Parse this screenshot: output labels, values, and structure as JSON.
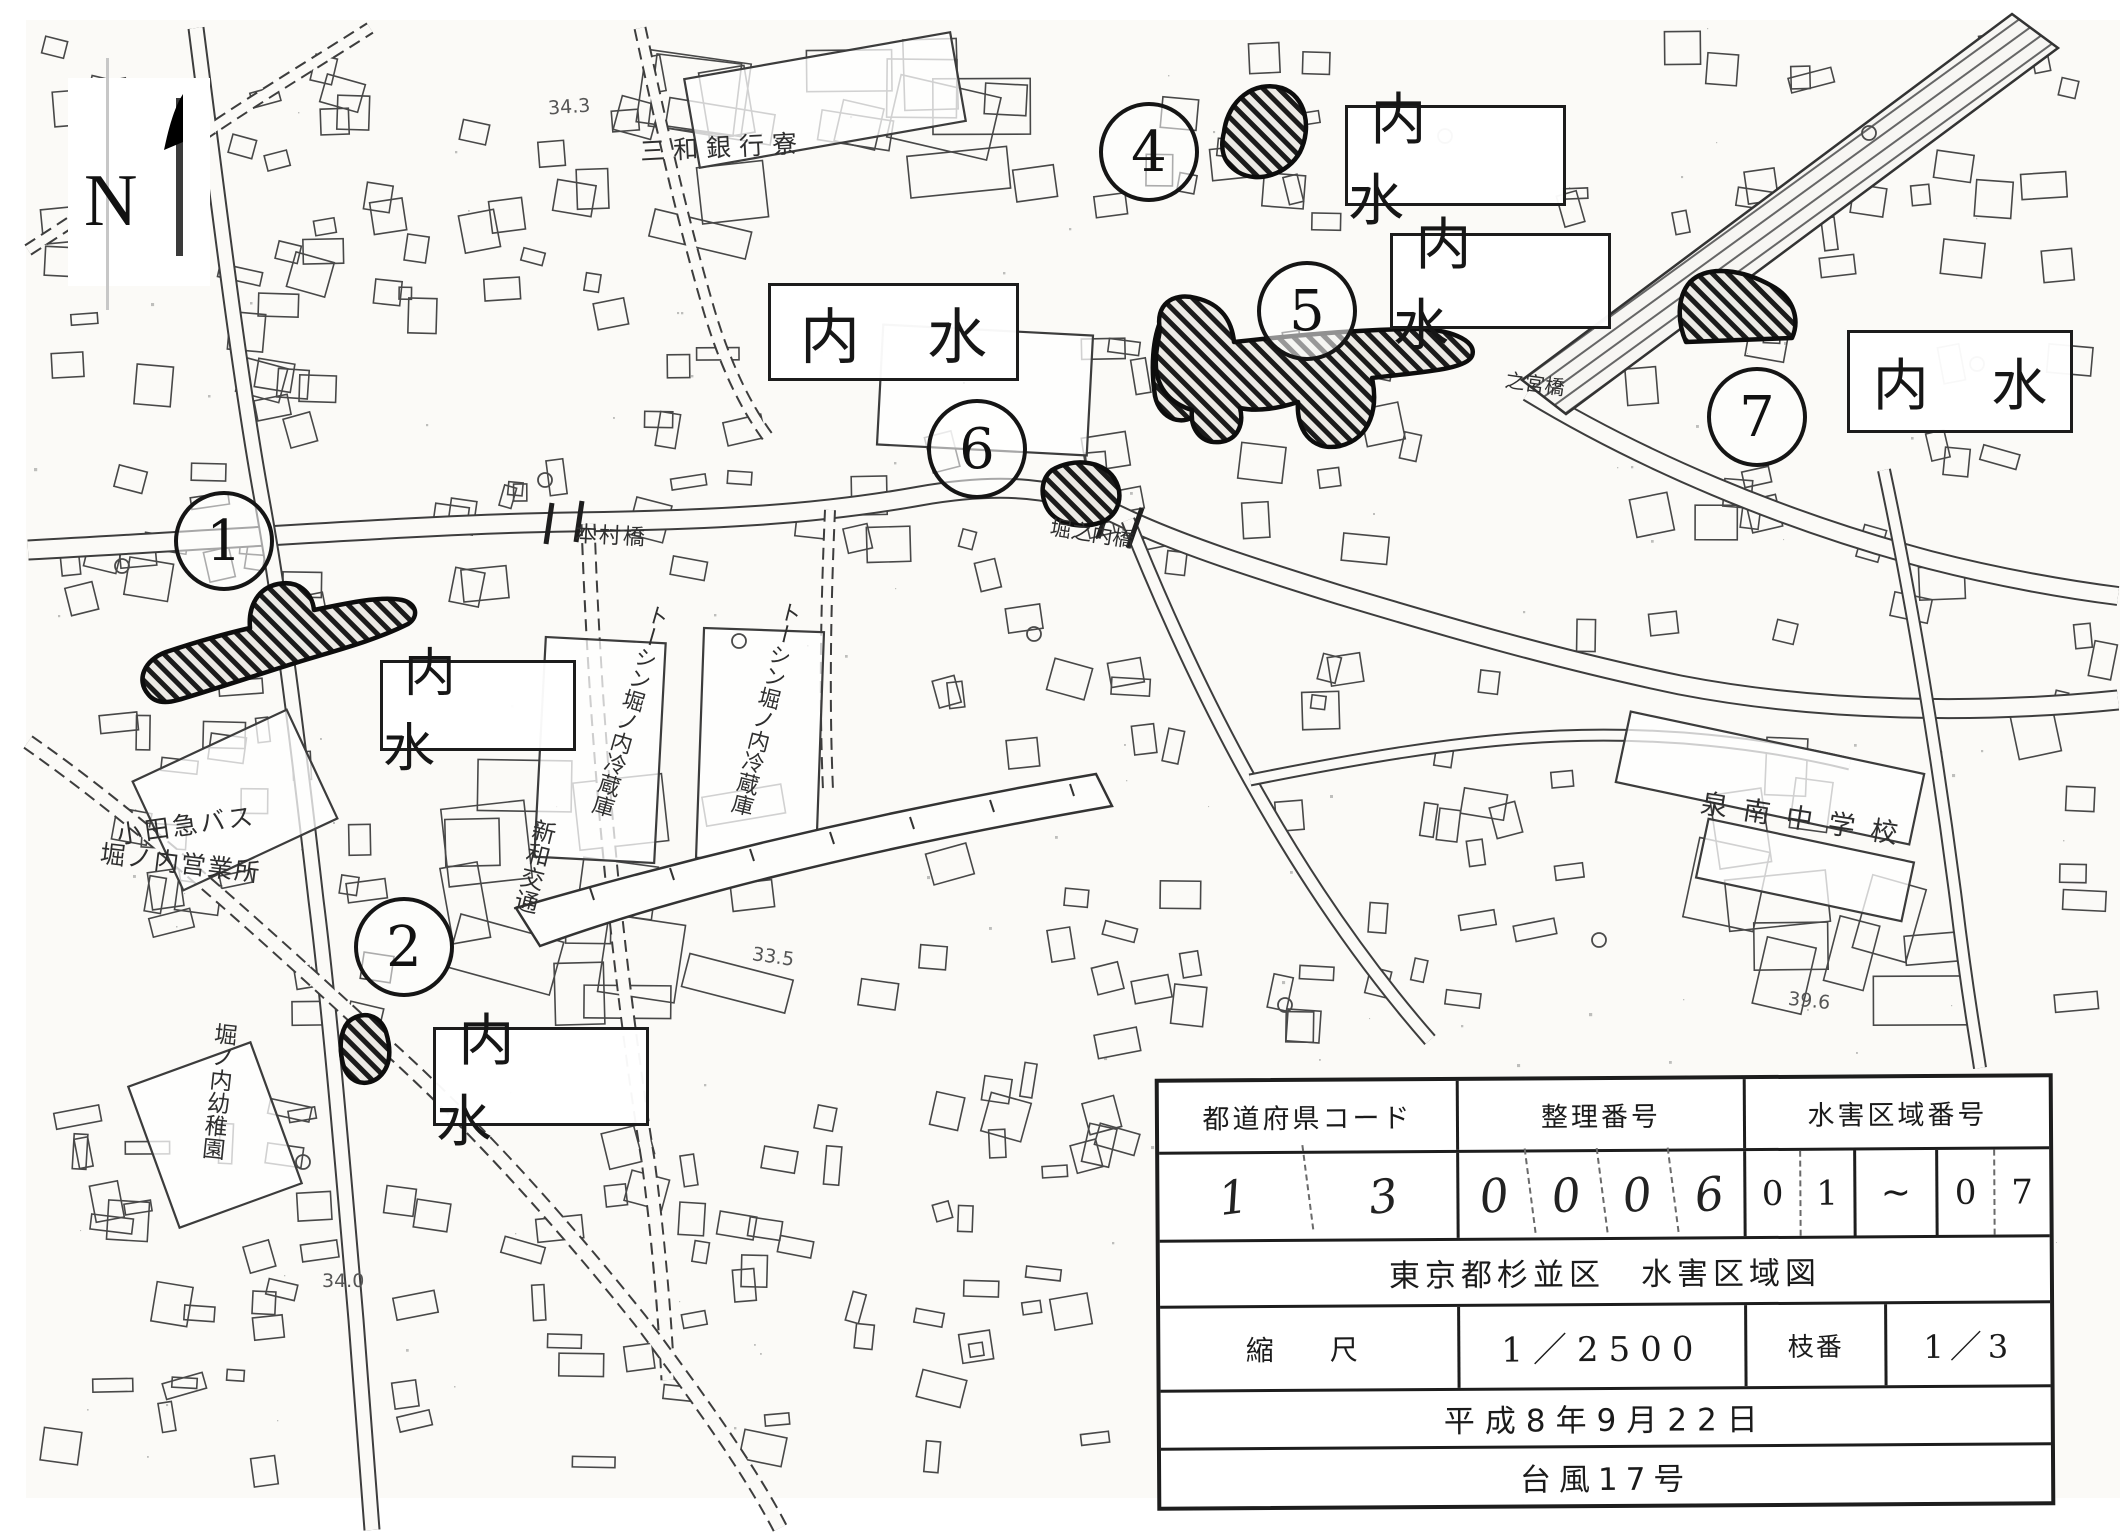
{
  "map": {
    "compass_label": "N",
    "flood_label": "内 水",
    "zones": [
      "1",
      "2",
      "4",
      "5",
      "6",
      "7"
    ],
    "labels": [
      {
        "text": "三和銀行寮"
      },
      {
        "text": "小田急バス"
      },
      {
        "text": "堀ノ内営業所"
      },
      {
        "text": "新和交通"
      },
      {
        "text": "トーシン堀ノ内冷蔵庫"
      },
      {
        "text": "トーシン堀ノ内冷蔵庫"
      },
      {
        "text": "堀ノ内幼稚園"
      },
      {
        "text": "泉南中学校"
      },
      {
        "text": "本村橋"
      },
      {
        "text": "堀之内橋"
      },
      {
        "text": "之宮橋"
      },
      {
        "text": "34.3"
      },
      {
        "text": "33.5"
      },
      {
        "text": "34.0"
      },
      {
        "text": "39.6"
      }
    ]
  },
  "info_table": {
    "col_headers": [
      "都道府県コード",
      "整理番号",
      "水害区域番号"
    ],
    "pref_code_digits": [
      "1",
      "3"
    ],
    "ref_number_digits": [
      "0",
      "0",
      "0",
      "6"
    ],
    "flood_start_digits": [
      "0",
      "1"
    ],
    "range_tilde": "~",
    "flood_end_digits": [
      "0",
      "7"
    ],
    "map_title": "東京都杉並区　水害区域図",
    "scale_label": "縮　尺",
    "scale_value": "1／2500",
    "branch_label": "枝番",
    "branch_value": "1／3",
    "date": "平成8年9月22日",
    "event": "台風17号"
  }
}
